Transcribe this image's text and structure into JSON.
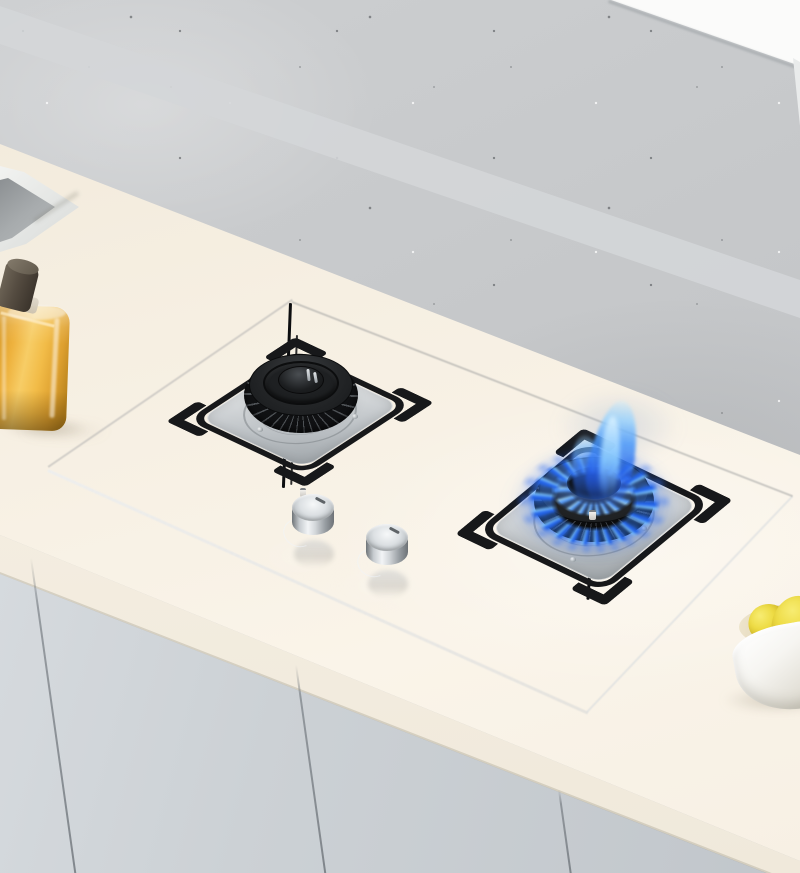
{
  "scene": {
    "type": "product-photo",
    "subject": "built-in two-burner gas cooktop on black tempered glass",
    "setting": "kitchen countertop against concrete wall",
    "state": {
      "left_burner": "off",
      "right_burner": "lit-blue-flame",
      "knob_count": 2
    },
    "props": [
      "kitchen-sink",
      "oil-bottle",
      "bowl-of-lemons",
      "base-cabinets",
      "upper-cabinet"
    ]
  },
  "colors": {
    "wall": "#c7c9cb",
    "wall_band": "#d4d6d8",
    "upper_cabinet": "#fbfbfa",
    "countertop": "#f6efe2",
    "counter_face": "#f0e9db",
    "cabinet": "#ccd1d5",
    "cabinet_seam": "#6c7278",
    "glass_dark": "#0e0f10",
    "glass_light": "#26282b",
    "steel_plate": "#d9dcde",
    "trivet": "#17181a",
    "burner_body": "#232527",
    "flame_core": "#2464e8",
    "flame_tip": "#7cc4ff",
    "flame_glow": "#3a86ff",
    "knob_silver": "#d4d8db",
    "oil_amber": "#f7cd66",
    "bottle_cap": "#554c41",
    "lemon": "#eedc45",
    "bowl": "#f6f5f1",
    "sink_basin": "#a7abad"
  }
}
